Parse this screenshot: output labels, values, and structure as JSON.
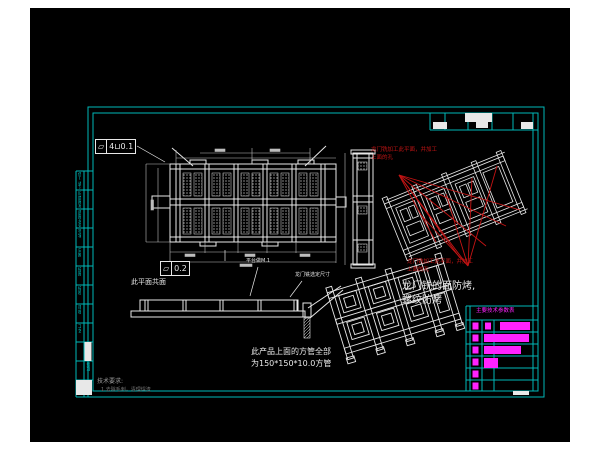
{
  "colors": {
    "canvas_bg": "#000000",
    "frame_cyan": "#00b8b8",
    "geometry_white": "#e8e8e8",
    "annotation_red": "#c41414",
    "table_magenta": "#ff22ff"
  },
  "annotations": {
    "fcf_top": {
      "symbol": "▱",
      "value": "4⊔0.1"
    },
    "fcf_mid": {
      "symbol": "▱",
      "value": "0.2"
    },
    "coplanar_note": "此平面共面",
    "platform_note": "平台做M.1",
    "gantry_dim_note": "龙门铣选定尺寸",
    "red_note_top_line1": "龙门铣加工此平面，并加工",
    "red_note_top_line2": "上面的孔",
    "red_note_bottom_line1": "龙门铣加工此平面，并加工",
    "red_note_bottom_line2": "上面的孔",
    "bake_note_line1": "龙门铣的面防烤,",
    "bake_note_line2": "螺纹防烤",
    "tube_note_line1": "此产品上面的方管全部",
    "tube_note_line2": "为150*150*10.0方管",
    "tech_req_title": "技术要求:",
    "tech_req_line1": "1.去除毛刺，清理焊渣"
  },
  "spec_table": {
    "header": "主要技术参数表"
  },
  "left_table": {
    "cells": [
      "借(通)用件登记",
      "旧底图总号",
      "底图总号",
      "签字",
      "日期",
      "描图",
      "描校",
      "审核",
      "工艺",
      "批准"
    ]
  }
}
